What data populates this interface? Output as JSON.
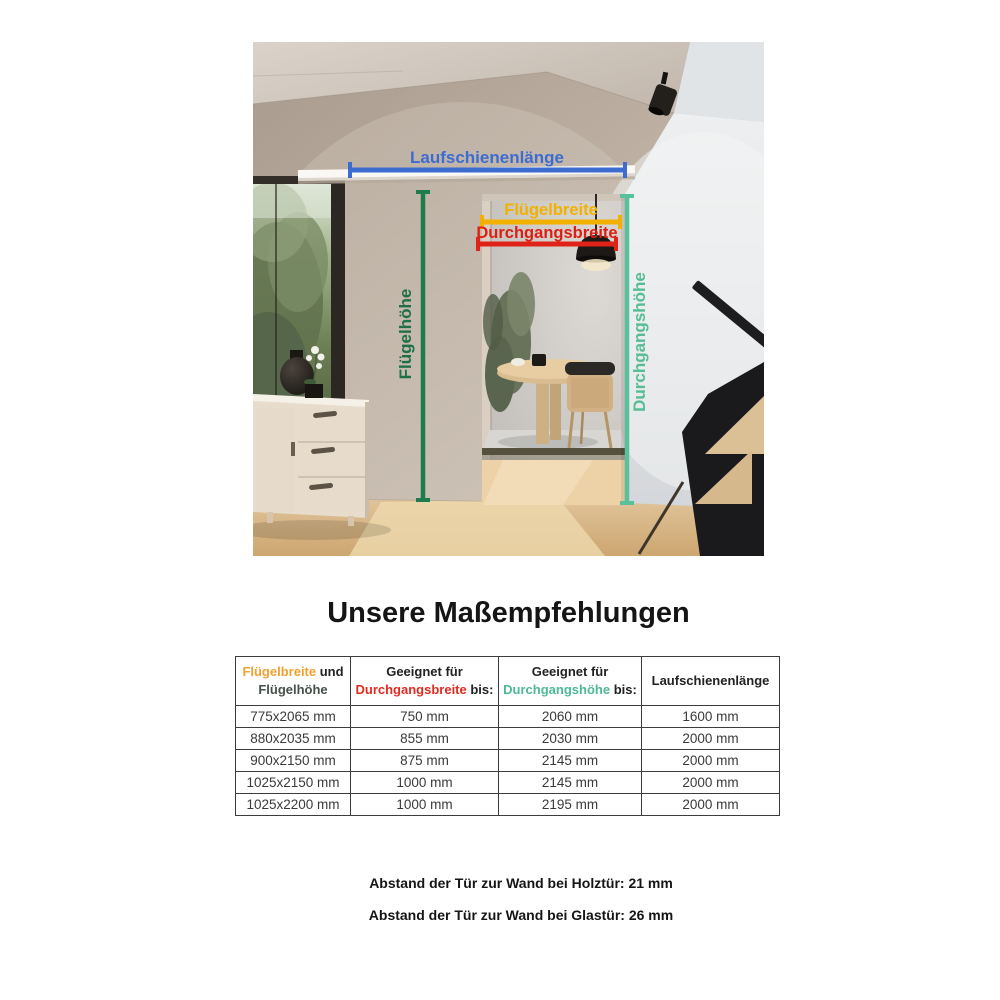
{
  "title": "Unsere Maßempfehlungen",
  "hero": {
    "annotations": {
      "laufschienenlaenge": {
        "label": "Laufschienenlänge",
        "color": "#3d6cd0"
      },
      "fluegelbreite": {
        "label": "Flügelbreite",
        "color": "#f2b100"
      },
      "durchgangsbreite": {
        "label": "Durchgangsbreite",
        "color": "#e02318"
      },
      "fluegelhoehe": {
        "label": "Flügelhöhe",
        "color": "#1e7b4e"
      },
      "durchgangshoehe": {
        "label": "Durchgangshöhe",
        "color": "#58c09a"
      }
    }
  },
  "table": {
    "header": {
      "col1_breite": "Flügelbreite",
      "col1_und": " und",
      "col1_hoehe": "Flügelhöhe",
      "col2_line1": "Geeignet für",
      "col2_term": "Durchgangsbreite",
      "col2_bis": " bis:",
      "col3_line1": "Geeignet für",
      "col3_term": "Durchgangshöhe",
      "col3_bis": " bis:",
      "col4": "Laufschienenlänge"
    },
    "rows": [
      [
        "775x2065 mm",
        "750 mm",
        "2060 mm",
        "1600 mm"
      ],
      [
        "880x2035 mm",
        "855 mm",
        "2030 mm",
        "2000 mm"
      ],
      [
        "900x2150 mm",
        "875 mm",
        "2145 mm",
        "2000 mm"
      ],
      [
        "1025x2150 mm",
        "1000 mm",
        "2145 mm",
        "2000 mm"
      ],
      [
        "1025x2200 mm",
        "1000 mm",
        "2195 mm",
        "2000 mm"
      ]
    ]
  },
  "notes": [
    "Abstand der Tür zur Wand bei Holztür: 21 mm",
    "Abstand der Tür zur Wand bei Glastür: 26 mm"
  ],
  "colors": {
    "orange_header": "#f0a132",
    "red_header": "#e02c20",
    "teal_header": "#4db896",
    "blue_header": "#3a67c0",
    "dark_green_header": "#44514a"
  }
}
